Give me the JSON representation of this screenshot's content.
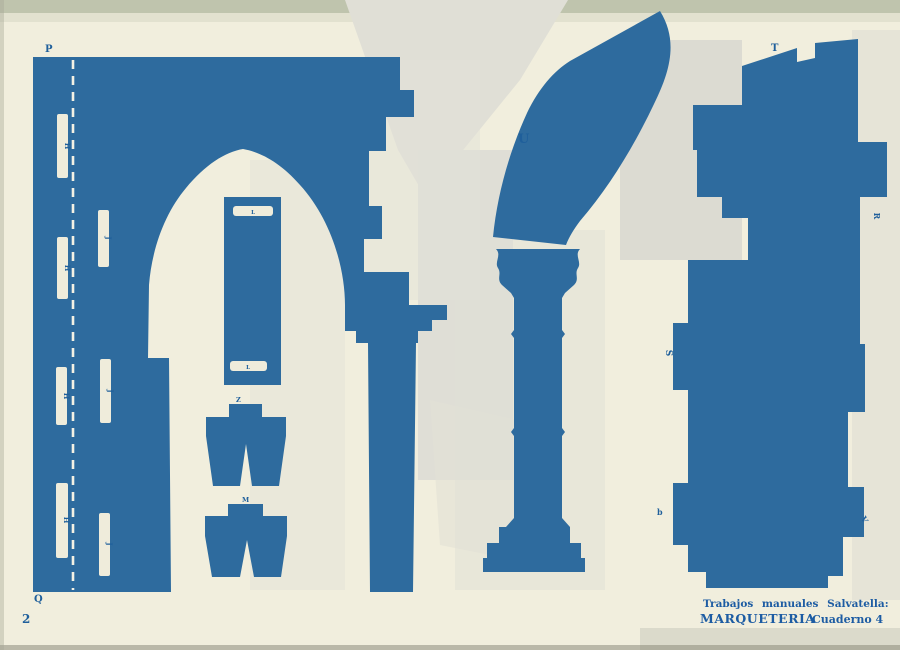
{
  "page_number": "2",
  "footer": {
    "series": "Trabajos manuales Salvatella:",
    "brand": "MARQUETERIA",
    "issue": "Cuaderno 4"
  },
  "part_labels": {
    "p": "P",
    "q": "Q",
    "u": "U",
    "t": "T",
    "s": "S",
    "r": "R",
    "v": "V",
    "b": "b",
    "z": "Z",
    "m": "M",
    "h": "H",
    "j": "J",
    "l": "L"
  },
  "colors": {
    "print_blue": "#2e6b9e",
    "paper": "#f1eedd",
    "label_blue": "#1f5f9b"
  }
}
